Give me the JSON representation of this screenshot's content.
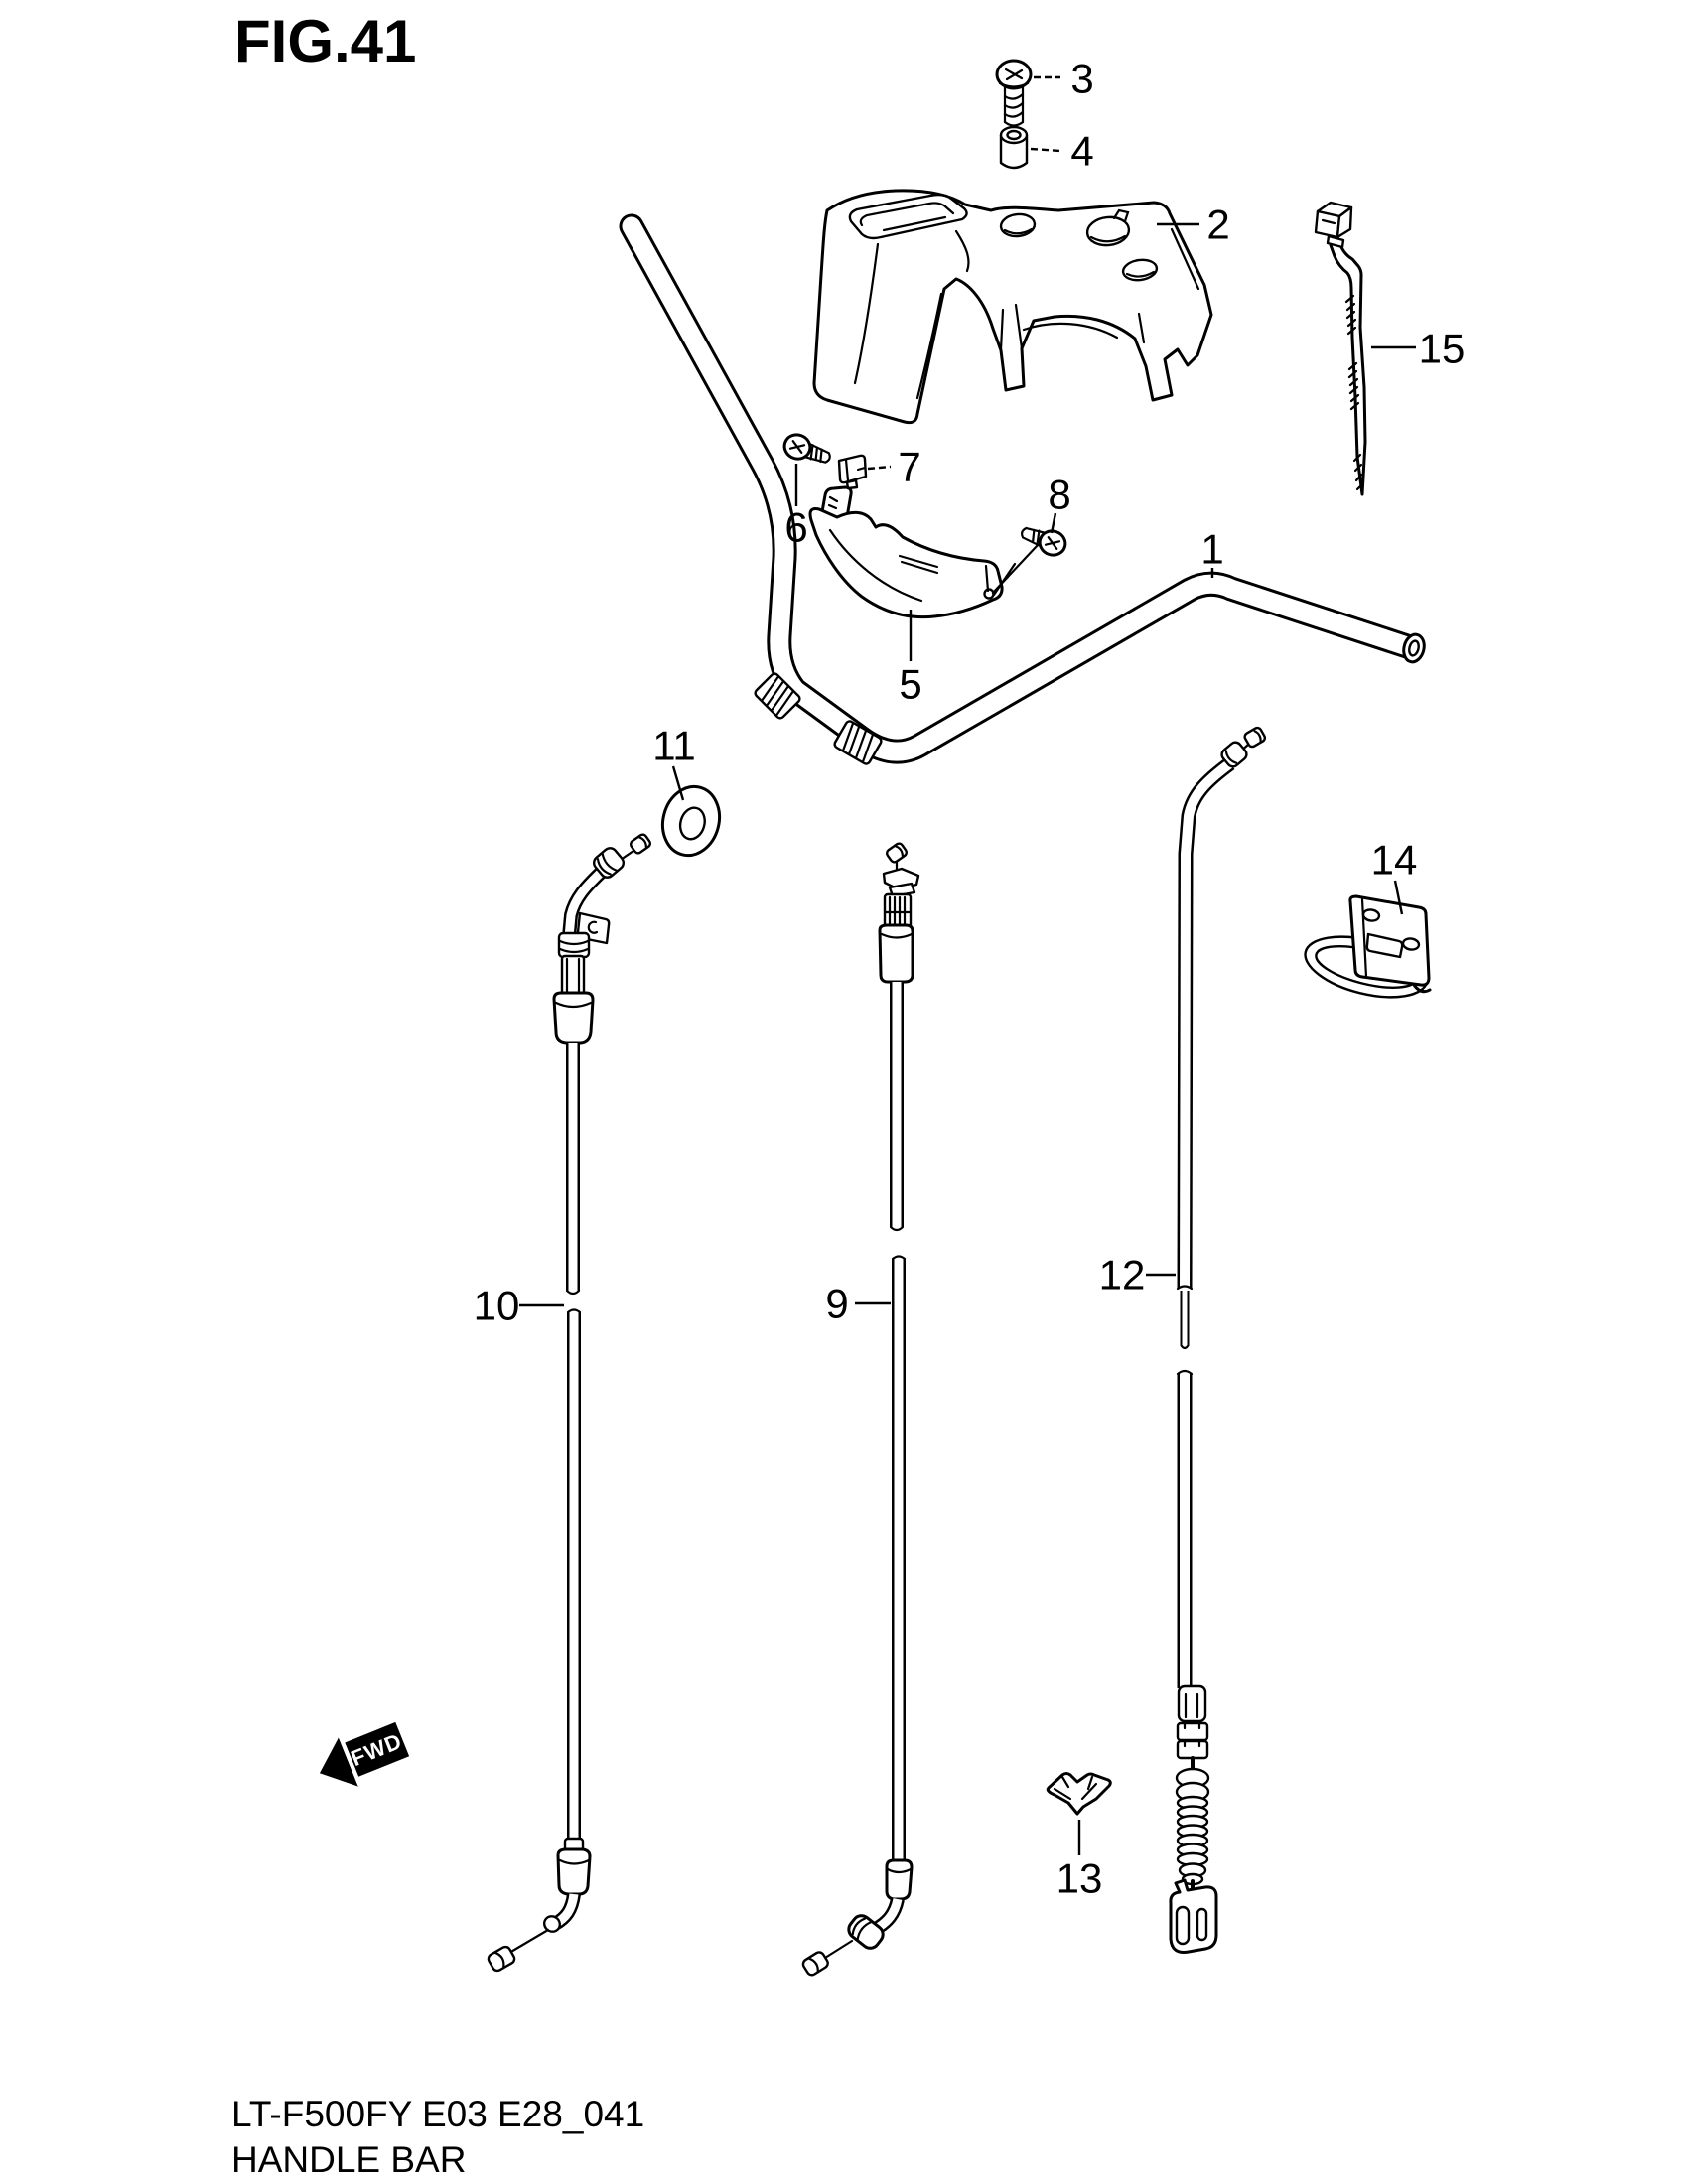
{
  "page": {
    "title": "FIG.41",
    "footer": {
      "model_code": "LT-F500FY E03 E28_041",
      "figure_name": "HANDLE BAR"
    }
  },
  "diagram": {
    "fwd_marker": "FWD",
    "ink_color": "#000000",
    "paper_color": "#ffffff",
    "callouts": [
      {
        "label": "1"
      },
      {
        "label": "2"
      },
      {
        "label": "3"
      },
      {
        "label": "4"
      },
      {
        "label": "5"
      },
      {
        "label": "6"
      },
      {
        "label": "7"
      },
      {
        "label": "8"
      },
      {
        "label": "9"
      },
      {
        "label": "10"
      },
      {
        "label": "11"
      },
      {
        "label": "12"
      },
      {
        "label": "13"
      },
      {
        "label": "14"
      },
      {
        "label": "15"
      }
    ]
  }
}
